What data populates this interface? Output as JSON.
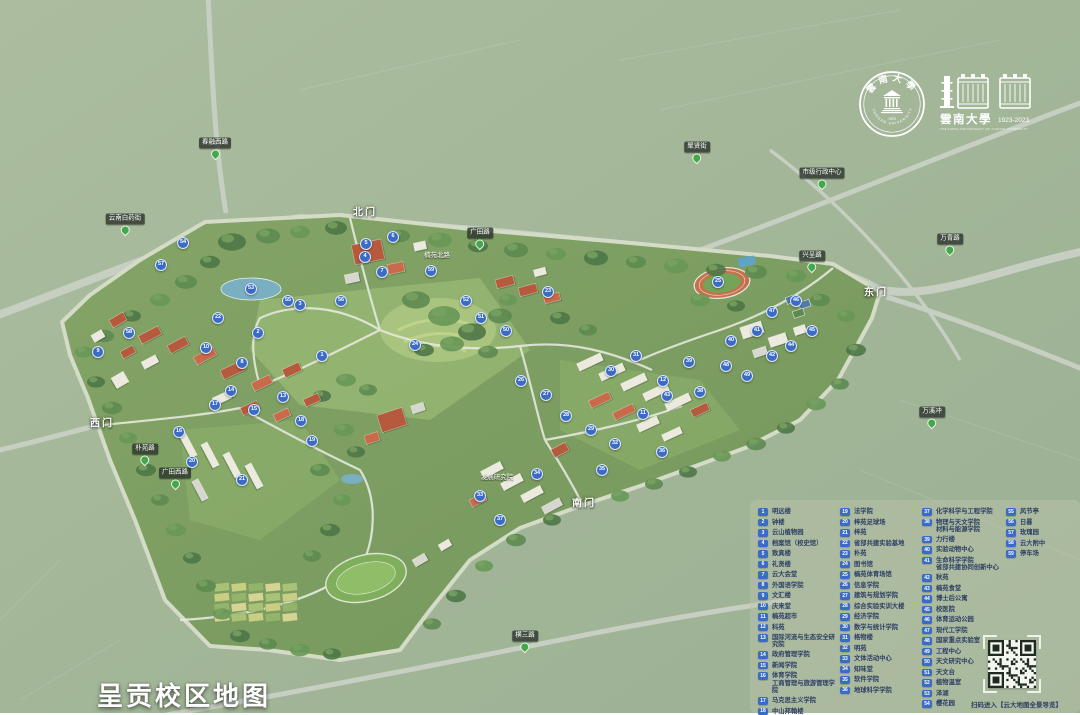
{
  "title": "呈贡校区地图",
  "logos": {
    "seal_cn": "雲南大學",
    "seal_en": "YUNNAN UNIVERSITY",
    "seal_year": "1923",
    "anniv_cn": "雲南大學",
    "anniv_years": "1923-2023",
    "anniv_en": "THE 100TH ANNIVERSARY OF YUNNAN UNIVERSITY"
  },
  "map": {
    "gates": [
      {
        "label": "北门",
        "x": 365,
        "y": 211
      },
      {
        "label": "东门",
        "x": 876,
        "y": 291
      },
      {
        "label": "西门",
        "x": 102,
        "y": 422
      },
      {
        "label": "南门",
        "x": 584,
        "y": 502
      }
    ],
    "pins": [
      {
        "label": "春融西路",
        "x": 215,
        "y": 152
      },
      {
        "label": "云南白药街",
        "x": 125,
        "y": 228
      },
      {
        "label": "聚贤街",
        "x": 697,
        "y": 156
      },
      {
        "label": "市级行政中心",
        "x": 822,
        "y": 182
      },
      {
        "label": "兴呈路",
        "x": 812,
        "y": 265
      },
      {
        "label": "万青路",
        "x": 950,
        "y": 248
      },
      {
        "label": "广田路",
        "x": 480,
        "y": 242
      },
      {
        "label": "朴苑路",
        "x": 145,
        "y": 458
      },
      {
        "label": "广田西路",
        "x": 175,
        "y": 482
      },
      {
        "label": "横三路",
        "x": 525,
        "y": 645
      },
      {
        "label": "万溪冲",
        "x": 932,
        "y": 421
      }
    ],
    "pois": [
      {
        "label": "发展研究院",
        "x": 497,
        "y": 476
      },
      {
        "label": "楠苑北路",
        "x": 437,
        "y": 254
      }
    ],
    "markers": [
      {
        "n": 1,
        "x": 322,
        "y": 356
      },
      {
        "n": 2,
        "x": 258,
        "y": 333
      },
      {
        "n": 3,
        "x": 300,
        "y": 305
      },
      {
        "n": 4,
        "x": 365,
        "y": 257
      },
      {
        "n": 5,
        "x": 366,
        "y": 244
      },
      {
        "n": 6,
        "x": 393,
        "y": 237
      },
      {
        "n": 7,
        "x": 382,
        "y": 272
      },
      {
        "n": 8,
        "x": 242,
        "y": 363
      },
      {
        "n": 9,
        "x": 98,
        "y": 352
      },
      {
        "n": 10,
        "x": 206,
        "y": 348
      },
      {
        "n": 11,
        "x": 643,
        "y": 414
      },
      {
        "n": 12,
        "x": 663,
        "y": 381
      },
      {
        "n": 13,
        "x": 283,
        "y": 397
      },
      {
        "n": 14,
        "x": 231,
        "y": 391
      },
      {
        "n": 15,
        "x": 254,
        "y": 410
      },
      {
        "n": 16,
        "x": 179,
        "y": 432
      },
      {
        "n": 17,
        "x": 215,
        "y": 405
      },
      {
        "n": 18,
        "x": 301,
        "y": 421
      },
      {
        "n": 19,
        "x": 312,
        "y": 441
      },
      {
        "n": 20,
        "x": 192,
        "y": 462
      },
      {
        "n": 21,
        "x": 242,
        "y": 480
      },
      {
        "n": 22,
        "x": 218,
        "y": 318
      },
      {
        "n": 23,
        "x": 548,
        "y": 292
      },
      {
        "n": 24,
        "x": 415,
        "y": 345
      },
      {
        "n": 25,
        "x": 718,
        "y": 282
      },
      {
        "n": 26,
        "x": 521,
        "y": 381
      },
      {
        "n": 27,
        "x": 546,
        "y": 395
      },
      {
        "n": 28,
        "x": 566,
        "y": 416
      },
      {
        "n": 29,
        "x": 591,
        "y": 430
      },
      {
        "n": 30,
        "x": 611,
        "y": 371
      },
      {
        "n": 31,
        "x": 636,
        "y": 356
      },
      {
        "n": 32,
        "x": 615,
        "y": 444
      },
      {
        "n": 33,
        "x": 480,
        "y": 496
      },
      {
        "n": 34,
        "x": 537,
        "y": 474
      },
      {
        "n": 35,
        "x": 602,
        "y": 470
      },
      {
        "n": 36,
        "x": 662,
        "y": 452
      },
      {
        "n": 37,
        "x": 500,
        "y": 520
      },
      {
        "n": 38,
        "x": 700,
        "y": 392
      },
      {
        "n": 39,
        "x": 689,
        "y": 362
      },
      {
        "n": 40,
        "x": 731,
        "y": 341
      },
      {
        "n": 41,
        "x": 757,
        "y": 331
      },
      {
        "n": 42,
        "x": 772,
        "y": 356
      },
      {
        "n": 43,
        "x": 667,
        "y": 396
      },
      {
        "n": 44,
        "x": 791,
        "y": 346
      },
      {
        "n": 45,
        "x": 812,
        "y": 331
      },
      {
        "n": 46,
        "x": 796,
        "y": 301
      },
      {
        "n": 47,
        "x": 772,
        "y": 312
      },
      {
        "n": 48,
        "x": 726,
        "y": 366
      },
      {
        "n": 49,
        "x": 747,
        "y": 376
      },
      {
        "n": 50,
        "x": 506,
        "y": 331
      },
      {
        "n": 51,
        "x": 481,
        "y": 318
      },
      {
        "n": 52,
        "x": 466,
        "y": 301
      },
      {
        "n": 53,
        "x": 251,
        "y": 289
      },
      {
        "n": 54,
        "x": 183,
        "y": 243
      },
      {
        "n": 55,
        "x": 288,
        "y": 301
      },
      {
        "n": 56,
        "x": 341,
        "y": 301
      },
      {
        "n": 57,
        "x": 161,
        "y": 265
      },
      {
        "n": 58,
        "x": 129,
        "y": 333
      },
      {
        "n": 59,
        "x": 431,
        "y": 271
      }
    ]
  },
  "legend": {
    "qr_note": "扫码进入【云大地图全景导览】",
    "columns": [
      {
        "items": [
          {
            "num": "1",
            "label": "明远楼"
          },
          {
            "num": "2",
            "label": "钟楼"
          },
          {
            "num": "3",
            "label": "云山植物园"
          },
          {
            "num": "4",
            "label": "档案馆（校史馆）"
          },
          {
            "num": "5",
            "label": "致真楼"
          },
          {
            "num": "6",
            "label": "礼贤楼"
          },
          {
            "num": "7",
            "label": "云大会堂"
          },
          {
            "num": "8",
            "label": "外国语学院"
          },
          {
            "num": "9",
            "label": "文汇楼"
          },
          {
            "num": "10",
            "label": "庆来堂"
          },
          {
            "num": "11",
            "label": "楠苑超市"
          },
          {
            "num": "12",
            "label": "科苑"
          },
          {
            "num": "13",
            "label": "国际河流与生态安全研究院"
          },
          {
            "num": "14",
            "label": "政府管理学院"
          },
          {
            "num": "15",
            "label": "新闻学院"
          },
          {
            "num": "16",
            "label": "体育学院\n工商管理与旅游管理学院"
          },
          {
            "num": "17",
            "label": "马克思主义学院"
          },
          {
            "num": "18",
            "label": "中山邦翰楼"
          }
        ]
      },
      {
        "items": [
          {
            "num": "19",
            "label": "法学院"
          },
          {
            "num": "20",
            "label": "梓苑足球场"
          },
          {
            "num": "21",
            "label": "梓苑"
          },
          {
            "num": "22",
            "label": "省部共建实验基地"
          },
          {
            "num": "23",
            "label": "朴苑"
          },
          {
            "num": "24",
            "label": "图书馆"
          },
          {
            "num": "25",
            "label": "楠苑体育场馆"
          },
          {
            "num": "26",
            "label": "信息学院"
          },
          {
            "num": "27",
            "label": "建筑与规划学院"
          },
          {
            "num": "28",
            "label": "综合实验实训大楼"
          },
          {
            "num": "29",
            "label": "经济学院"
          },
          {
            "num": "30",
            "label": "数学与统计学院"
          },
          {
            "num": "31",
            "label": "格物楼"
          },
          {
            "num": "32",
            "label": "明苑"
          },
          {
            "num": "33",
            "label": "文体活动中心"
          },
          {
            "num": "34",
            "label": "知味堂"
          },
          {
            "num": "35",
            "label": "软件学院"
          },
          {
            "num": "36",
            "label": "地球科学学院"
          }
        ]
      },
      {
        "items": [
          {
            "num": "37",
            "label": "化学科学与工程学院"
          },
          {
            "num": "38",
            "label": "物理与天文学院\n材料与能源学院"
          },
          {
            "num": "39",
            "label": "力行楼"
          },
          {
            "num": "40",
            "label": "实验动物中心"
          },
          {
            "num": "41",
            "label": "生命科学学院\n省部共建协同创新中心"
          },
          {
            "num": "42",
            "label": "秋苑"
          },
          {
            "num": "43",
            "label": "楠苑食堂"
          },
          {
            "num": "44",
            "label": "博士后公寓"
          },
          {
            "num": "45",
            "label": "校医院"
          },
          {
            "num": "46",
            "label": "体育运动公园"
          },
          {
            "num": "47",
            "label": "现代工学院"
          },
          {
            "num": "48",
            "label": "国家重点实验室"
          },
          {
            "num": "49",
            "label": "工程中心"
          },
          {
            "num": "50",
            "label": "天文研究中心"
          },
          {
            "num": "51",
            "label": "天文台"
          },
          {
            "num": "52",
            "label": "植物温室"
          },
          {
            "num": "53",
            "label": "泽湖"
          },
          {
            "num": "54",
            "label": "樱花园"
          }
        ]
      },
      {
        "items": [
          {
            "num": "55",
            "label": "风节亭"
          },
          {
            "num": "56",
            "label": "日晷"
          },
          {
            "num": "57",
            "label": "玫瑰园"
          },
          {
            "num": "58",
            "label": "云大附中"
          },
          {
            "num": "59",
            "label": "停车场"
          }
        ]
      }
    ]
  }
}
